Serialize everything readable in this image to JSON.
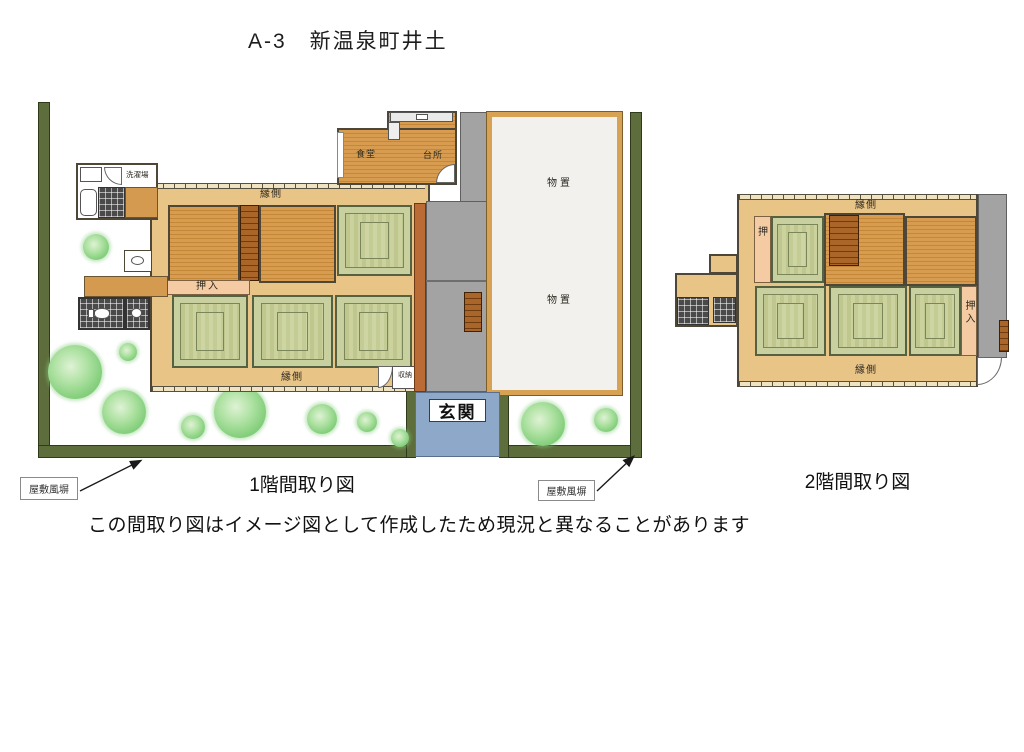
{
  "title": "A-3　新温泉町井土",
  "floor1": {
    "caption": "1階間取り図",
    "labels": {
      "laundry": "洗濯場",
      "dining": "食堂",
      "kitchen": "台所",
      "veranda_top": "縁側",
      "veranda_bottom": "縁側",
      "oshiire": "押入",
      "storage_upper": "物置",
      "storage_lower": "物置",
      "shunou": "収納",
      "entrance": "玄関",
      "fence_left": "屋敷風塀",
      "fence_right": "屋敷風塀"
    }
  },
  "floor2": {
    "caption": "2階間取り図",
    "labels": {
      "veranda_top": "縁側",
      "veranda_bottom": "縁側",
      "oshi": "押",
      "oshiire": "押入"
    }
  },
  "disclaimer": "この間取り図はイメージ図として作成したため現況と異なることがあります",
  "colors": {
    "wood": "#d79c4f",
    "wood_line": "#c48637",
    "tatami": "#c9d0a0",
    "tatami_border": "#556242",
    "veranda": "#e8c487",
    "closet": "#f4cba3",
    "corridor_gray": "#a3a3a3",
    "stairs": "#aa6529",
    "rust_wall": "#bb6b35",
    "fence_olive": "#5e6d3c",
    "entrance_blue": "#8ea8ca",
    "storage_wall": "#d7a254",
    "storage_floor": "#f3f1ed",
    "tile_dark": "#4a4a4a",
    "tree_green": "#7cc875"
  }
}
